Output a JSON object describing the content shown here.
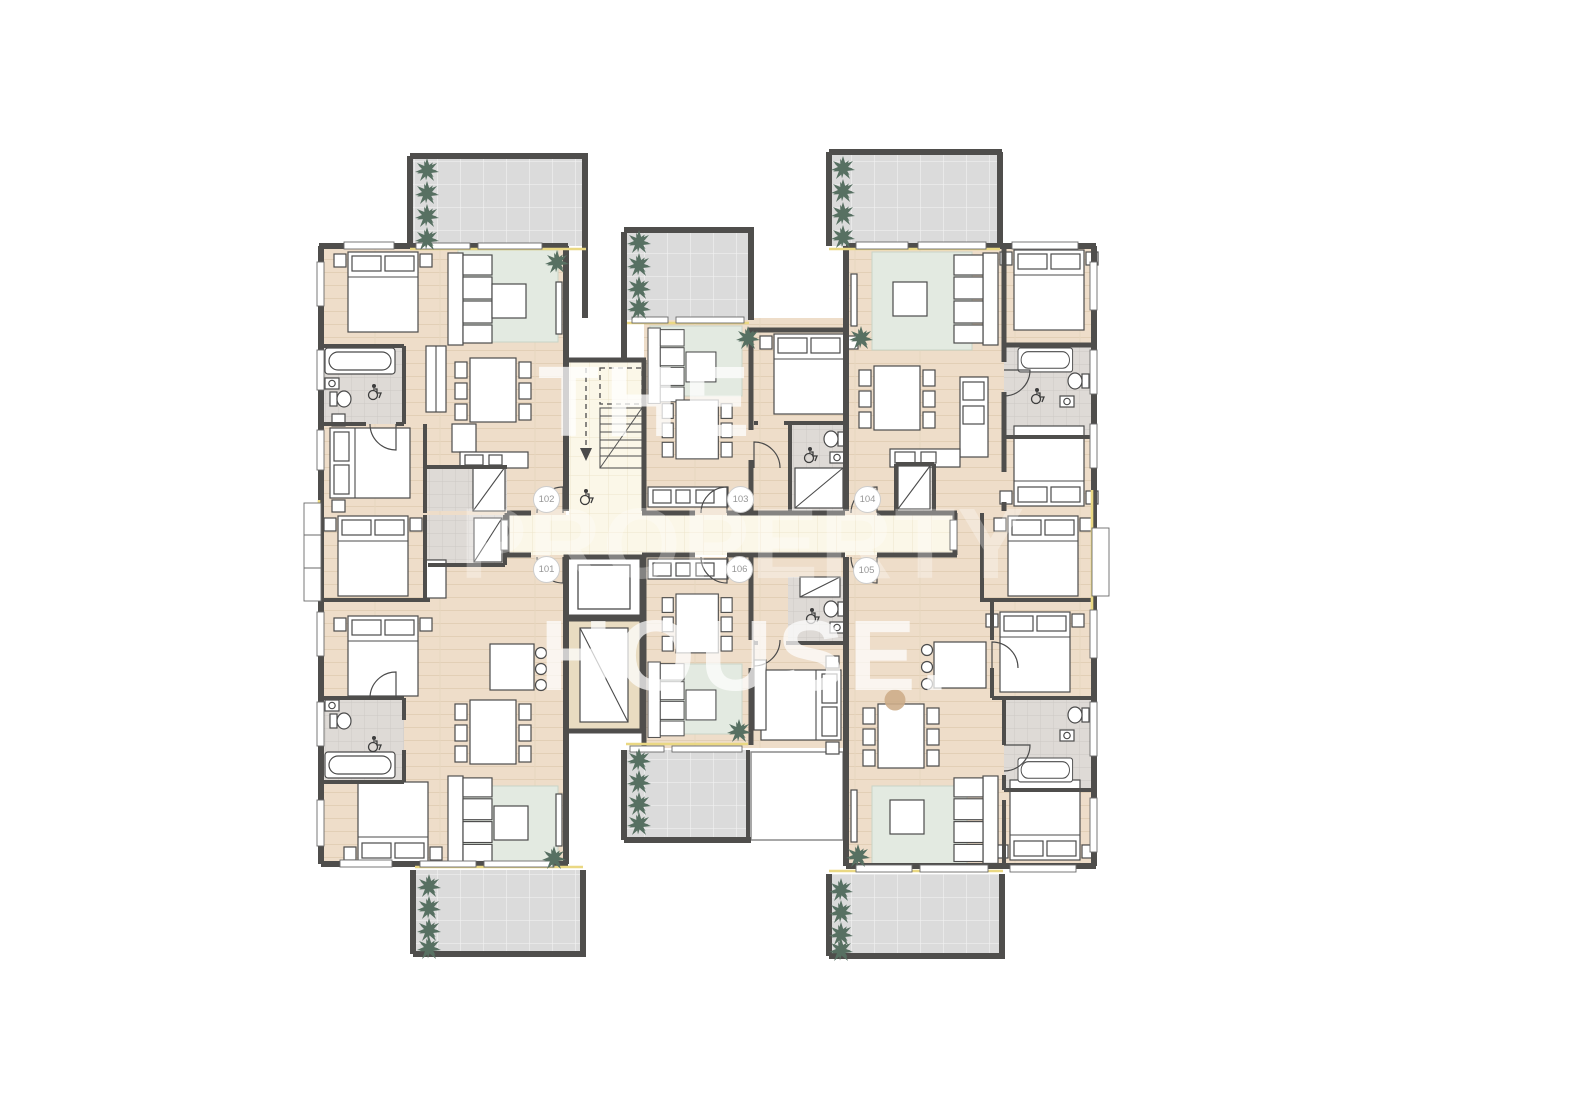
{
  "plan": {
    "type": "apartment-building-floor-plan",
    "watermark": {
      "line1": "THE",
      "line2": "PROPERTY",
      "line3": "HOUSE."
    },
    "units": [
      {
        "id": "101"
      },
      {
        "id": "102"
      },
      {
        "id": "103"
      },
      {
        "id": "104"
      },
      {
        "id": "105"
      },
      {
        "id": "106"
      }
    ],
    "icons": {
      "wheelchair": "wheelchair-icon",
      "plant": "plant-icon",
      "stairs": "stairs-icon",
      "elevator": "elevator-icon"
    },
    "colors": {
      "wall": "#4f4e4c",
      "floor": "#eeddc9",
      "terrace": "#dbdbdb",
      "corridor": "#fbf7e8",
      "bath_tile": "#dedad6",
      "rug": "#e3eae1",
      "plant": "#577062",
      "sill_accent": "#ead883",
      "watermark": "#ffffff",
      "badge_text": "#979797",
      "period_dot": "#cdad8a"
    }
  }
}
